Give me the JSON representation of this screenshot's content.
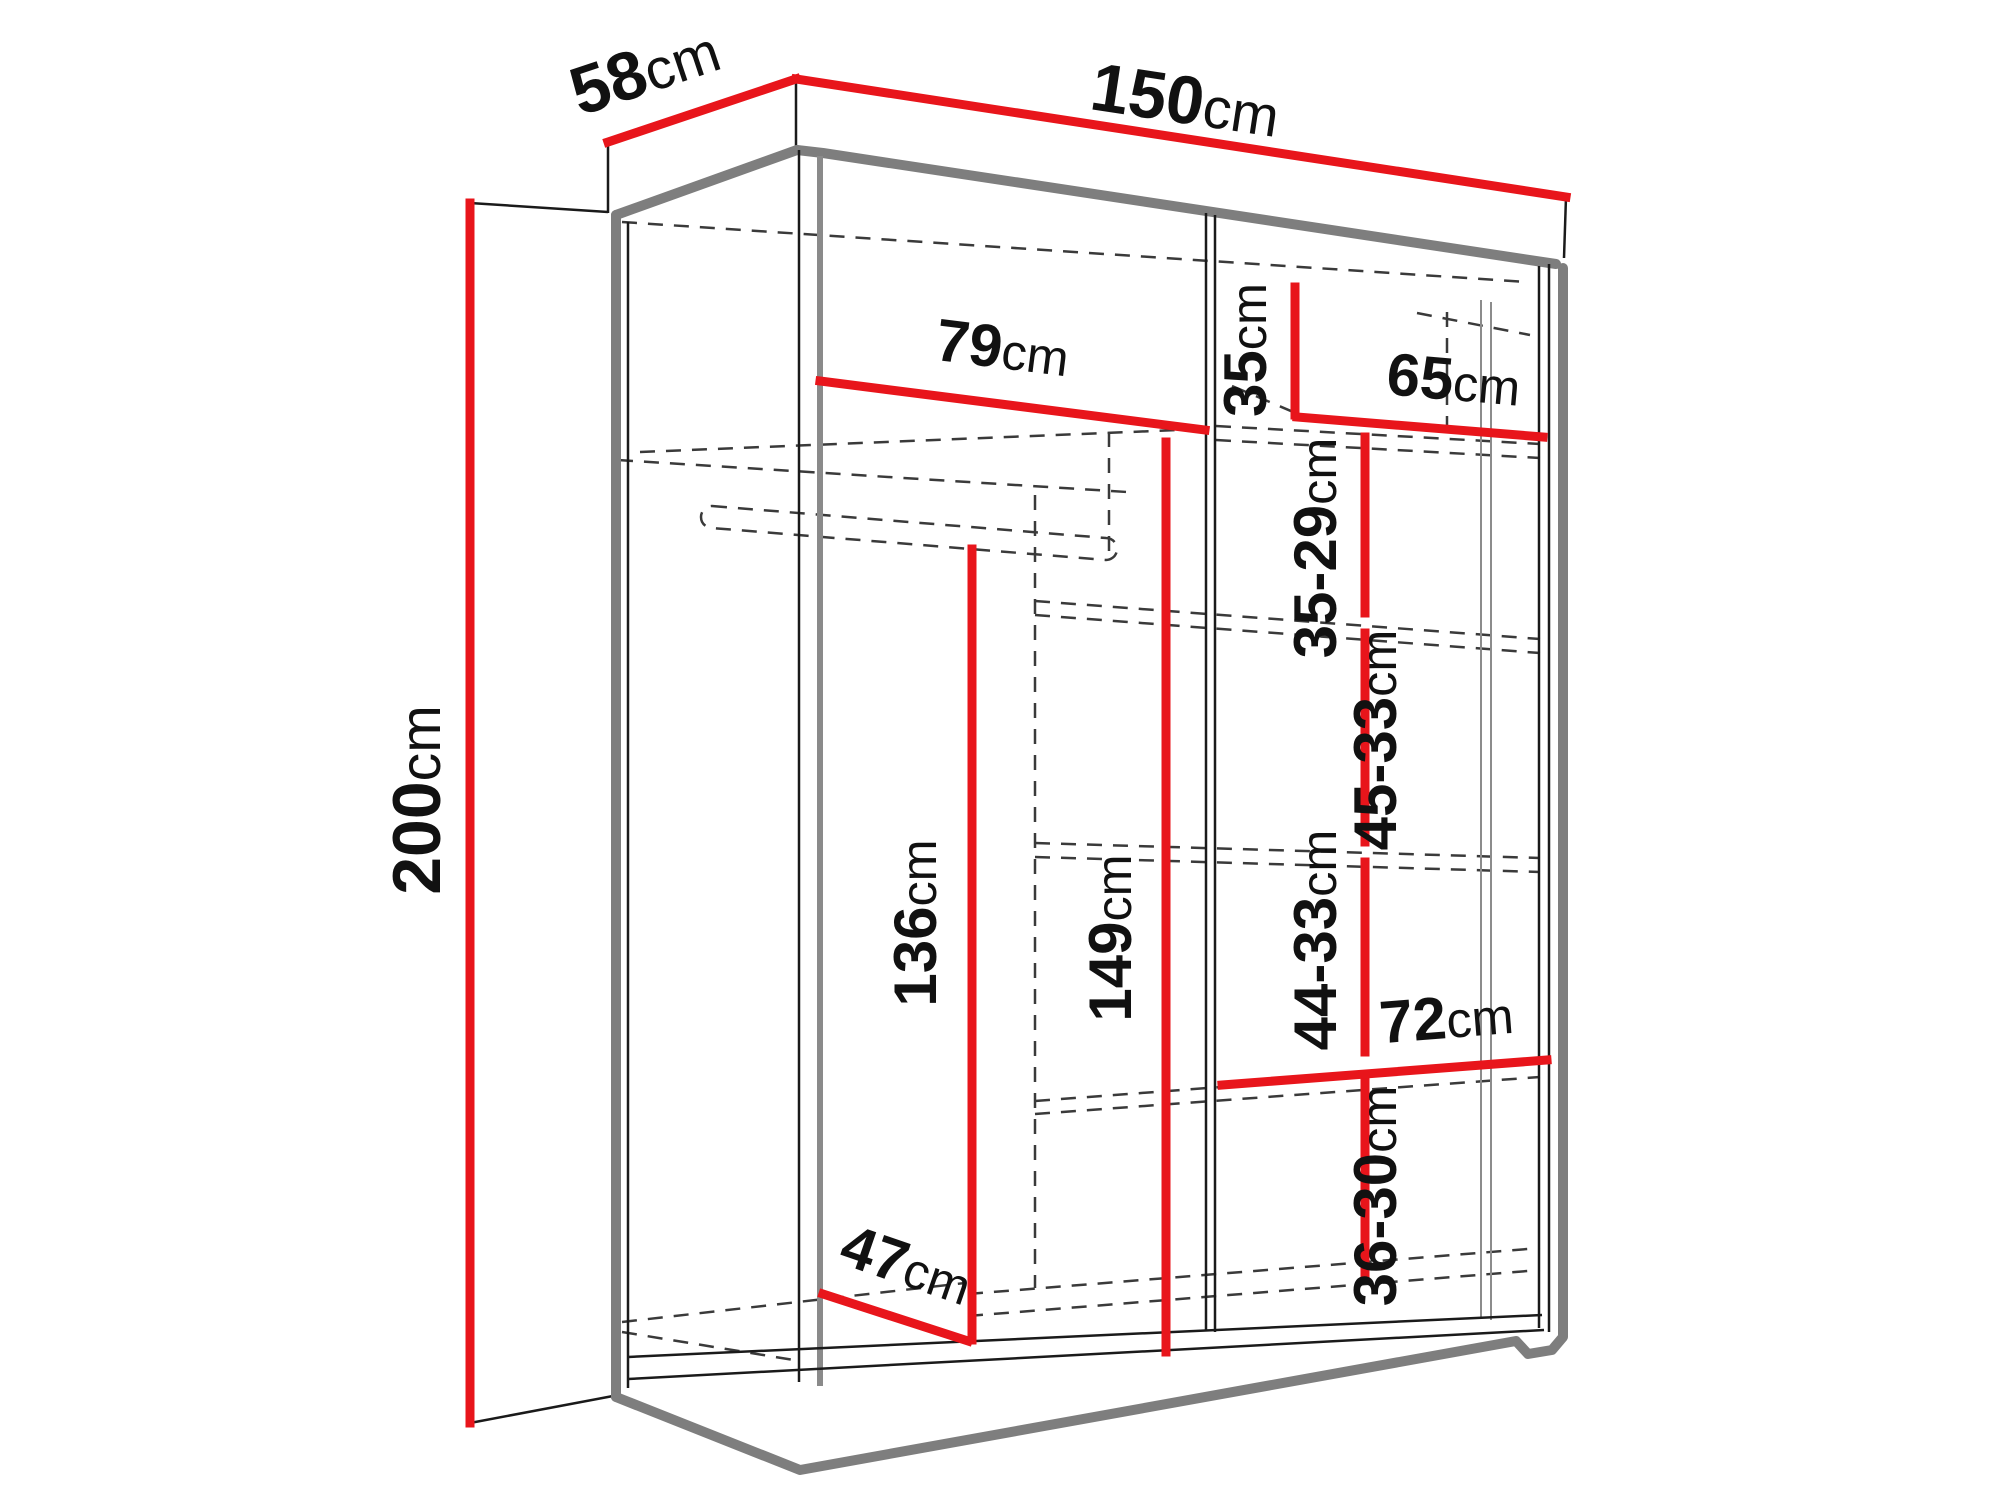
{
  "diagram": {
    "subject": "wardrobe-dimension-diagram",
    "unit": "cm",
    "colors": {
      "dimension_line": "#e8151b",
      "structure_edge": "#7e7e7e",
      "outline": "#1a1a1a",
      "hidden_edge_dash": "#3a3a3a",
      "background": "#ffffff"
    },
    "dimensions": {
      "overall_width_cm": 150,
      "overall_depth_cm": 58,
      "overall_height_cm": 200,
      "left_section_width_cm": 79,
      "right_section_width_cm": 65,
      "top_shelf_drop_cm": 35,
      "shelf_gap_1_cm": "35-29",
      "shelf_gap_2_cm": "45-33",
      "shelf_gap_3_cm": "44-33",
      "shelf_gap_4_cm": "36-30",
      "bottom_shelf_width_cm": 72,
      "hanging_space_height_cm": 136,
      "interior_height_cm": 149,
      "floor_diagonal_cm": 47
    }
  },
  "labels": {
    "depth": {
      "value": "58",
      "unit": "cm"
    },
    "width": {
      "value": "150",
      "unit": "cm"
    },
    "height": {
      "value": "200",
      "unit": "cm"
    },
    "left_width": {
      "value": "79",
      "unit": "cm"
    },
    "top_shelf": {
      "value": "35",
      "unit": "cm"
    },
    "right_width": {
      "value": "65",
      "unit": "cm"
    },
    "gap1": {
      "value": "35-29",
      "unit": "cm"
    },
    "gap2": {
      "value": "45-33",
      "unit": "cm"
    },
    "gap3": {
      "value": "44-33",
      "unit": "cm"
    },
    "gap4": {
      "value": "36-30",
      "unit": "cm"
    },
    "shelf_width": {
      "value": "72",
      "unit": "cm"
    },
    "hang_height": {
      "value": "136",
      "unit": "cm"
    },
    "inner_height": {
      "value": "149",
      "unit": "cm"
    },
    "floor_diagonal": {
      "value": "47",
      "unit": "cm"
    }
  }
}
